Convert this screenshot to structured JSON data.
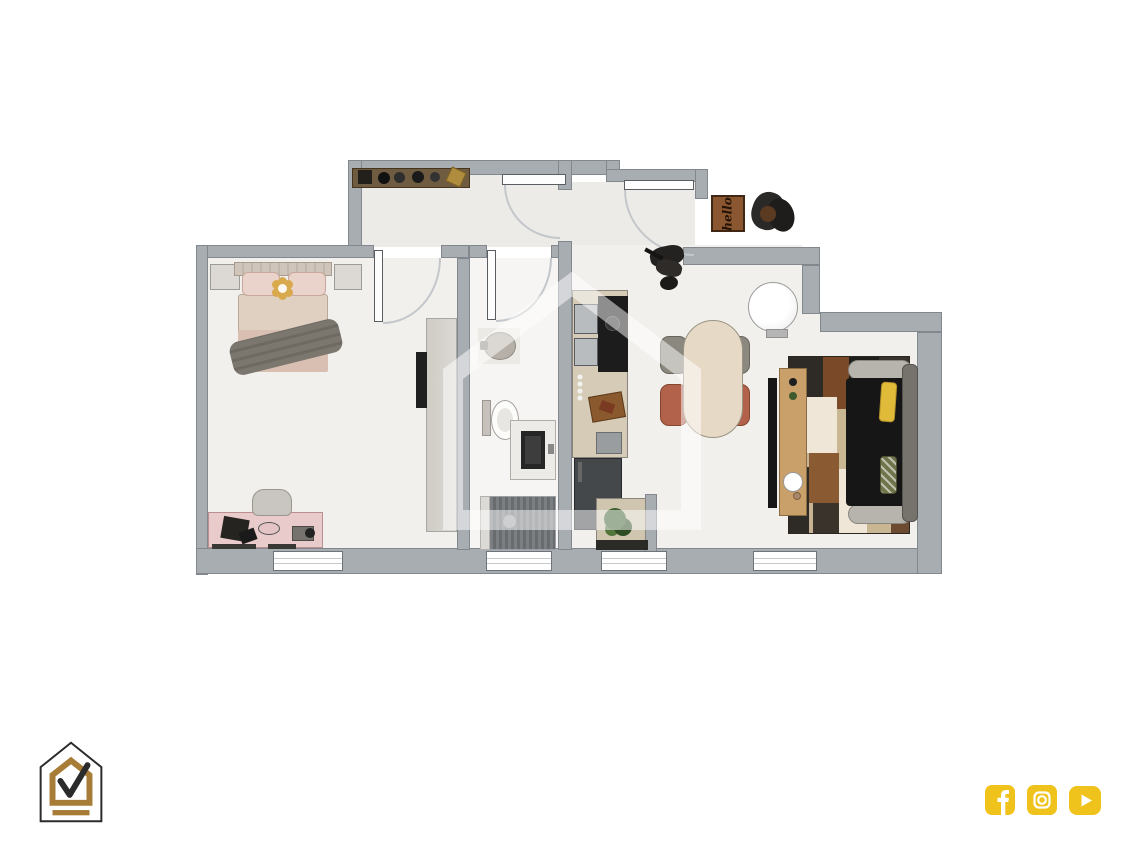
{
  "doormat": {
    "text": "hello"
  },
  "branding": {
    "logo_name": "house-check-logo",
    "logo_outline_color": "#2b2b2b",
    "logo_accent_color": "#a67c36"
  },
  "social": {
    "accent_color": "#efc31c",
    "icons": [
      "facebook",
      "instagram",
      "youtube"
    ]
  },
  "floor_plan": {
    "type": "apartment-top-down-render",
    "wall_color": "#a8adb2",
    "floor_color": "#f2f0ed",
    "rooms": [
      "hallway",
      "entry-vestibule",
      "bedroom",
      "bathroom",
      "kitchen",
      "dining-area",
      "living-room",
      "entry-landing"
    ],
    "furniture": [
      "hall-shelf",
      "double-bed",
      "nightstand-left",
      "nightstand-right",
      "wardrobe",
      "bedroom-tv",
      "desk",
      "desk-chair",
      "laptop",
      "camera",
      "bidet",
      "toilet",
      "vanity-sink",
      "shower",
      "kitchen-cabinets",
      "range",
      "knobs",
      "cutting-board",
      "kitchen-sink",
      "fridge",
      "corner-counter",
      "plant",
      "dining-table",
      "gray-chairs",
      "terracotta-chairs",
      "water-heater",
      "doormat",
      "coat-rack",
      "bicycle",
      "patchwork-rug",
      "sofa",
      "yellow-pillow",
      "green-pillow",
      "tv-console",
      "living-tv",
      "house-watermark"
    ]
  }
}
